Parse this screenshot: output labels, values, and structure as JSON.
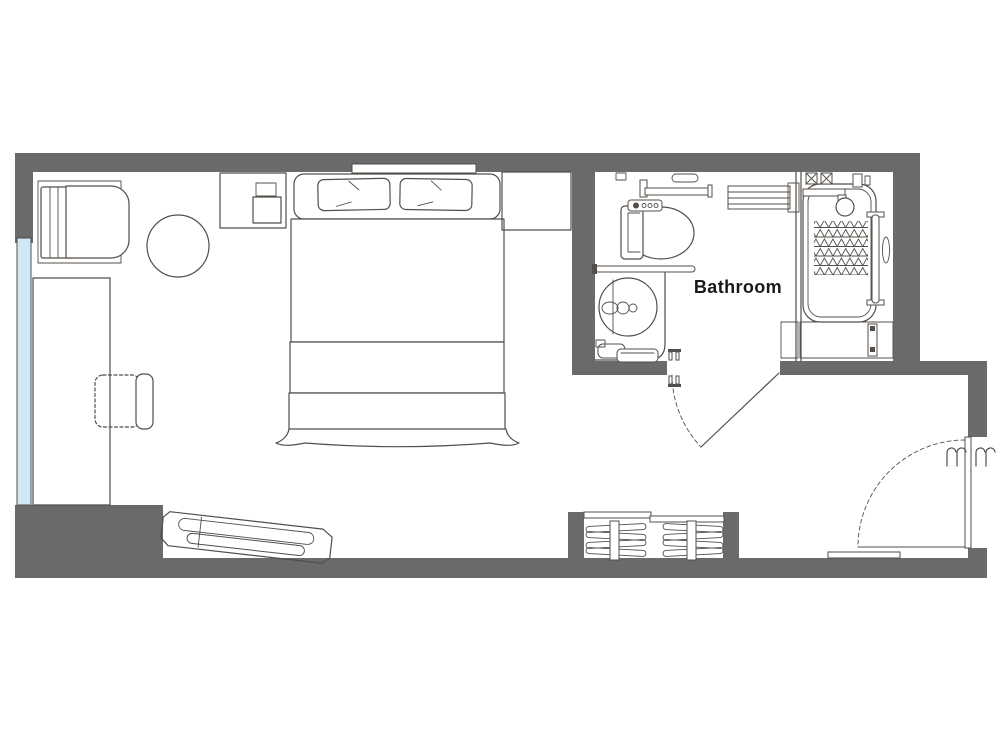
{
  "title": "Hotel room floor plan",
  "labels": {
    "bathroom": "Bathroom"
  },
  "colors": {
    "paper": "#ffffff",
    "wall": "#6a6a6a",
    "line": "#534e49",
    "window": "#cfe7f7",
    "hatch": "#7d736a",
    "text": "#1a1a1a"
  },
  "rooms": [
    {
      "name": "bedroom",
      "label": ""
    },
    {
      "name": "bathroom",
      "label": "Bathroom"
    }
  ],
  "doors": [
    {
      "name": "bathroom-door",
      "type": "swing"
    },
    {
      "name": "entrance-door",
      "type": "swing"
    }
  ],
  "furniture": [
    "lounge-chair",
    "round-side-table",
    "desk",
    "desk-chair",
    "window",
    "double-bed",
    "pillow",
    "pillow",
    "headboard-shelf",
    "nightstand-left",
    "nightstand-right",
    "angled-bench",
    "luggage-rack",
    "toilet",
    "grab-bar",
    "towel-ring",
    "towel-bar",
    "vanity-counter",
    "wash-basin",
    "bucket",
    "bath-stool",
    "towel-shelf",
    "bathtub",
    "shower-mixer",
    "hand-shower",
    "bathtub-handrail",
    "duckboard"
  ]
}
